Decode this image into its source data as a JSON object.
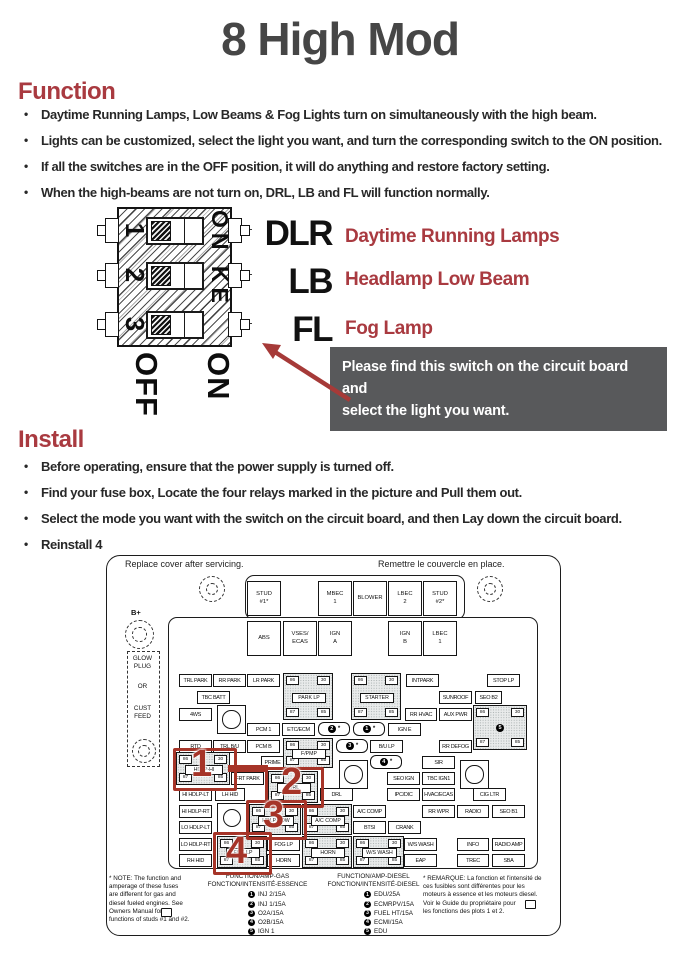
{
  "title": "8 High Mod",
  "function_section": {
    "heading": "Function",
    "bullets": [
      "Daytime Running Lamps, Low Beams & Fog Lights turn on simultaneously with the high beam.",
      "Lights can be customized, select the light you want, and turn the corresponding switch to the ON position.",
      "If all the switches are in the OFF position, it will do anything and restore factory setting.",
      "When the high-beams are not turn on, DRL, LB and FL will function normally."
    ]
  },
  "install_section": {
    "heading": "Install",
    "bullets": [
      "Before operating, ensure that the power supply is turned off.",
      "Find your fuse box, Locate the four relays marked in the picture and Pull them out.",
      "Select the mode you want with the switch on the circuit board, and then Lay down the circuit board.",
      "Reinstall 4"
    ]
  },
  "switch_diagram": {
    "numbers": [
      "1",
      "2",
      "3"
    ],
    "side_label": "ON KE",
    "off_label": "OFF",
    "on_label": "ON",
    "rows": [
      {
        "code": "DLR",
        "desc": "Daytime Running Lamps"
      },
      {
        "code": "LB",
        "desc": "Headlamp Low Beam"
      },
      {
        "code": "FL",
        "desc": "Fog Lamp"
      }
    ],
    "callout": {
      "line1": "Please find this switch on the circuit board and",
      "line2": "select the light you want."
    }
  },
  "fusebox": {
    "note_left": "Replace cover after servicing.",
    "note_right": "Remettre le couvercle en place.",
    "b_plus": "B+",
    "side_labels": [
      "GLOW\nPLUG",
      "OR",
      "CUST\nFEED"
    ],
    "pins": [
      "86",
      "30",
      "87",
      "85"
    ],
    "squares": [
      {
        "label": "STUD\n#1*",
        "x": 162,
        "y": 36
      },
      {
        "label": "MBEC\n1",
        "x": 233,
        "y": 36
      },
      {
        "label": "BLOWER",
        "x": 268,
        "y": 36
      },
      {
        "label": "LBEC\n2",
        "x": 303,
        "y": 36
      },
      {
        "label": "STUD\n#2*",
        "x": 338,
        "y": 36
      },
      {
        "label": "ABS",
        "x": 162,
        "y": 76
      },
      {
        "label": "VSES/\nECAS",
        "x": 198,
        "y": 76
      },
      {
        "label": "IGN\nA",
        "x": 233,
        "y": 76
      },
      {
        "label": "IGN\nB",
        "x": 303,
        "y": 76
      },
      {
        "label": "LBEC\n1",
        "x": 338,
        "y": 76
      }
    ],
    "fuses": [
      {
        "label": "TRL PARK",
        "x": 94,
        "y": 129
      },
      {
        "label": "RR PARK",
        "x": 128,
        "y": 129
      },
      {
        "label": "LR PARK",
        "x": 162,
        "y": 129
      },
      {
        "label": "INTPARK",
        "x": 321,
        "y": 129
      },
      {
        "label": "STOP LP",
        "x": 402,
        "y": 129
      },
      {
        "label": "TBC BATT",
        "x": 112,
        "y": 146
      },
      {
        "label": "SUNROOF",
        "x": 354,
        "y": 146
      },
      {
        "label": "SEO B2",
        "x": 390,
        "y": 146,
        "w": 25
      },
      {
        "label": "4WS",
        "x": 94,
        "y": 163
      },
      {
        "label": "RR HVAC",
        "x": 320,
        "y": 163,
        "w": 30
      },
      {
        "label": "AUX PWR",
        "x": 354,
        "y": 163
      },
      {
        "label": "PCM 1",
        "x": 162,
        "y": 178
      },
      {
        "label": "ETC/ECM",
        "x": 197,
        "y": 178
      },
      {
        "label": "IGN E",
        "x": 303,
        "y": 178
      },
      {
        "label": "RTD",
        "x": 94,
        "y": 195
      },
      {
        "label": "TRL B/U",
        "x": 128,
        "y": 195
      },
      {
        "label": "PCM B",
        "x": 162,
        "y": 195
      },
      {
        "label": "B/U LP",
        "x": 285,
        "y": 195
      },
      {
        "label": "RR DEFOG",
        "x": 354,
        "y": 195
      },
      {
        "label": "PRIME",
        "x": 176,
        "y": 211,
        "w": 21
      },
      {
        "label": "SIR",
        "x": 337,
        "y": 211
      },
      {
        "label": "FRT PARK",
        "x": 146,
        "y": 227
      },
      {
        "label": "SEO IGN",
        "x": 302,
        "y": 227
      },
      {
        "label": "TBC IGN1",
        "x": 337,
        "y": 227
      },
      {
        "label": "HI HDLP-LT",
        "x": 94,
        "y": 243
      },
      {
        "label": "LH HID",
        "x": 130,
        "y": 243,
        "w": 28
      },
      {
        "label": "DRL",
        "x": 235,
        "y": 243
      },
      {
        "label": "IPC/DIC",
        "x": 302,
        "y": 243
      },
      {
        "label": "HVAC/ECAS",
        "x": 337,
        "y": 243
      },
      {
        "label": "CIG LTR",
        "x": 388,
        "y": 243
      },
      {
        "label": "HI HDLP-RT",
        "x": 94,
        "y": 260
      },
      {
        "label": "A/C COMP",
        "x": 268,
        "y": 260
      },
      {
        "label": "RR WPR",
        "x": 337,
        "y": 260
      },
      {
        "label": "RADIO",
        "x": 372,
        "y": 260,
        "w": 30
      },
      {
        "label": "SEO B1",
        "x": 407,
        "y": 260
      },
      {
        "label": "LO HDLP-LT",
        "x": 94,
        "y": 276
      },
      {
        "label": "BTSI",
        "x": 268,
        "y": 276
      },
      {
        "label": "CRANK",
        "x": 303,
        "y": 276
      },
      {
        "label": "LO HDLP-RT",
        "x": 94,
        "y": 293
      },
      {
        "label": "FOG LP",
        "x": 182,
        "y": 293
      },
      {
        "label": "W/S WASH",
        "x": 319,
        "y": 293
      },
      {
        "label": "INFO",
        "x": 372,
        "y": 293,
        "w": 30
      },
      {
        "label": "RADIO AMP",
        "x": 407,
        "y": 293
      },
      {
        "label": "RH HID",
        "x": 94,
        "y": 309
      },
      {
        "label": "HORN",
        "x": 182,
        "y": 309
      },
      {
        "label": "EAP",
        "x": 319,
        "y": 309
      },
      {
        "label": "TREC",
        "x": 372,
        "y": 309,
        "w": 30
      },
      {
        "label": "SBA",
        "x": 407,
        "y": 309
      }
    ],
    "relays": [
      {
        "name": "PARK LP",
        "x": 198,
        "y": 128,
        "w": 48,
        "h": 45
      },
      {
        "name": "STARTER",
        "x": 266,
        "y": 128,
        "w": 48,
        "h": 45
      },
      {
        "name": "F/PMP",
        "x": 198,
        "y": 193,
        "w": 48,
        "h": 28
      },
      {
        "name": "HDLP-HI",
        "x": 91,
        "y": 207,
        "w": 52,
        "h": 31
      },
      {
        "name": "DRL",
        "x": 183,
        "y": 226,
        "w": 48,
        "h": 30
      },
      {
        "name": "HDLP-LOW",
        "x": 164,
        "y": 259,
        "w": 50,
        "h": 29
      },
      {
        "name": "A/C COMP",
        "x": 217,
        "y": 259,
        "w": 48,
        "h": 29
      },
      {
        "name": "FOG LP",
        "x": 132,
        "y": 291,
        "w": 48,
        "h": 30
      },
      {
        "name": "HORN",
        "x": 217,
        "y": 291,
        "w": 48,
        "h": 30
      },
      {
        "name": "W/S WASH",
        "x": 268,
        "y": 291,
        "w": 49,
        "h": 30
      },
      {
        "name": "",
        "num": "5",
        "x": 388,
        "y": 160,
        "w": 52,
        "h": 43
      }
    ],
    "ovals": [
      {
        "num": "2",
        "x": 233,
        "y": 177
      },
      {
        "num": "1",
        "x": 268,
        "y": 177
      },
      {
        "num": "3",
        "x": 251,
        "y": 194
      },
      {
        "num": "4",
        "x": 285,
        "y": 210
      }
    ],
    "screws": [
      {
        "x": 132,
        "y": 160,
        "s": 27
      },
      {
        "x": 254,
        "y": 215,
        "s": 27
      },
      {
        "x": 375,
        "y": 215,
        "s": 27
      },
      {
        "x": 132,
        "y": 258,
        "s": 28
      }
    ],
    "highlights": [
      {
        "num": "1",
        "x": 88,
        "y": 203,
        "w": 58,
        "h": 37,
        "nx": 106,
        "ny": 200
      },
      {
        "num": "2",
        "x": 180,
        "y": 222,
        "w": 53,
        "h": 35,
        "nx": 196,
        "ny": 218
      },
      {
        "num": "3",
        "x": 161,
        "y": 255,
        "w": 55,
        "h": 34,
        "nx": 178,
        "ny": 251
      },
      {
        "num": "4",
        "x": 128,
        "y": 287,
        "w": 53,
        "h": 37,
        "nx": 141,
        "ny": 287
      }
    ],
    "legend": {
      "gas_header": [
        "FUNCTION/AMP-GAS",
        "FONCTION/INTENSITÉ-ESSENCE"
      ],
      "gas_items": [
        {
          "num": "1",
          "label": "INJ 2/15A"
        },
        {
          "num": "2",
          "label": "INJ 1/15A"
        },
        {
          "num": "3",
          "label": "O2A/15A"
        },
        {
          "num": "4",
          "label": "O2B/15A"
        },
        {
          "num": "5",
          "label": "IGN 1"
        }
      ],
      "diesel_header": [
        "FUNCTION/AMP-DIESEL",
        "FONCTION/INTENSITÉ-DIESEL"
      ],
      "diesel_items": [
        {
          "num": "1",
          "label": "EDU/25A"
        },
        {
          "num": "2",
          "label": "ECMRPV/15A"
        },
        {
          "num": "3",
          "label": "FUEL HT/15A"
        },
        {
          "num": "4",
          "label": "ECMI/15A"
        },
        {
          "num": "5",
          "label": "EDU"
        }
      ],
      "note_lines": [
        "* NOTE:  The function and",
        "amperage of these fuses",
        "are different for gas and",
        "diesel fueled engines.  See",
        "Owners Manual        for",
        "functions of studs #1 and #2."
      ],
      "remarque_lines": [
        "* REMARQUE:  La fonction et l'intensité de",
        "ces fusibles sont différentes pour les",
        "moteurs à essence et les moteurs diesel.",
        "Voir le Guide du propriétaire        pour",
        "les fonctions des plots 1 et 2."
      ]
    }
  },
  "colors": {
    "accent_red": "#a93a40",
    "highlight_red": "#a63428",
    "callout_gray": "#58595b",
    "title_gray": "#464646"
  }
}
